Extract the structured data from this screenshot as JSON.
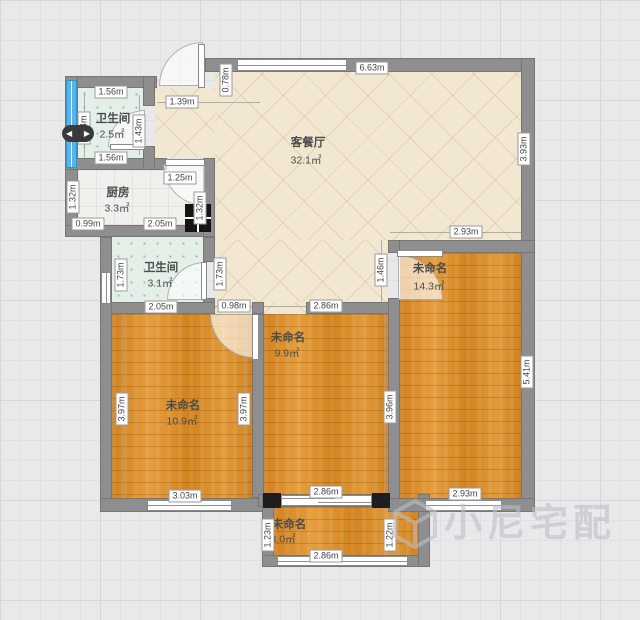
{
  "rooms": {
    "living": {
      "name": "客餐厅",
      "area": "32.1㎡"
    },
    "bath1": {
      "name": "卫生间",
      "area": "2.5㎡"
    },
    "kitchen": {
      "name": "厨房",
      "area": "3.3㎡"
    },
    "bath2": {
      "name": "卫生间",
      "area": "3.1㎡"
    },
    "bedroom_right": {
      "name": "未命名",
      "area": "14.3㎡"
    },
    "bedroom_mid": {
      "name": "未命名",
      "area": "9.9㎡"
    },
    "bedroom_left": {
      "name": "未命名",
      "area": "10.9㎡"
    },
    "balcony": {
      "name": "未命名",
      "area": "3.0㎡"
    }
  },
  "dims": {
    "living_top": "6.63m",
    "entry_depth": "0.78m",
    "entry_width": "1.39m",
    "living_right": "3.93m",
    "living_bottom_right": "2.93m",
    "bath1_top": "1.56m",
    "bath1_bottom": "1.56m",
    "bath1_left": "1.34m",
    "bath1_right": "1.43m",
    "kitchen_top": "1.25m",
    "kitchen_left": "1.32m",
    "kitchen_right": "1.32m",
    "kitchen_bottom_left": "0.99m",
    "kitchen_bottom": "2.05m",
    "bath2_left": "1.73m",
    "bath2_right": "1.73m",
    "bath2_bottom": "2.05m",
    "hall_width": "0.98m",
    "mid_top": "2.86m",
    "mid_right": "3.96m",
    "mid_bottom": "2.86m",
    "right_entry": "1.46m",
    "right_side": "5.41m",
    "right_bottom": "2.93m",
    "left_left": "3.97m",
    "left_right": "3.97m",
    "left_bottom": "3.03m",
    "balcony_left": "1.23m",
    "balcony_right": "1.22m",
    "balcony_bottom": "2.86m"
  },
  "ui": {
    "pan_left": "◀",
    "pan_right": "▶"
  },
  "watermark": {
    "brand": "小尼宅配"
  },
  "colors": {
    "wall": "#8e8e8e",
    "floor_tile": "#f2e7d1",
    "floor_wood": "#d98c28",
    "floor_bath": "#e4f0e7",
    "window_blue": "#4db7ee",
    "pillar": "#1e1e1e",
    "background": "#e9e9eb"
  }
}
